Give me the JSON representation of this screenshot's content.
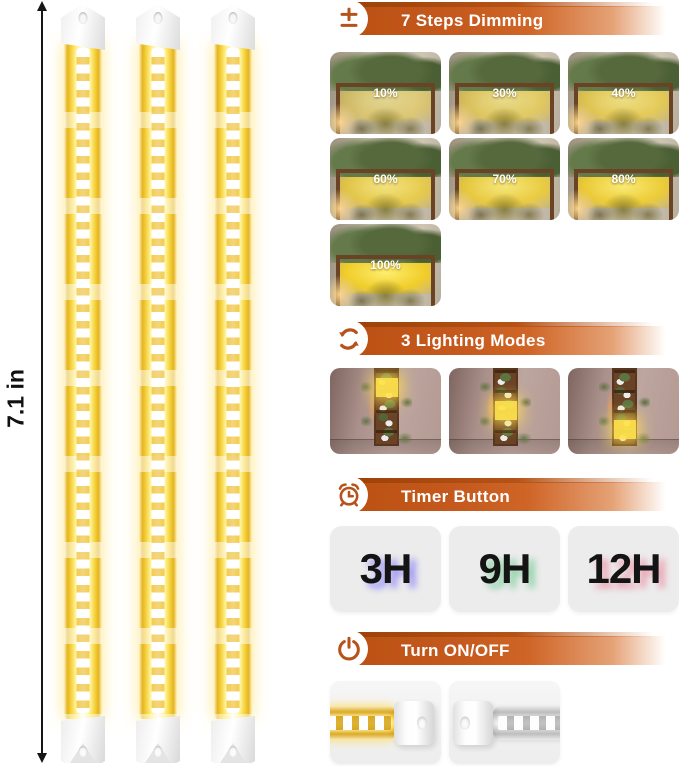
{
  "colors": {
    "banner_orange": "#c65a1e",
    "banner_ridge": "#9e4208",
    "icon_orange": "#b5531a",
    "led_yellow": "#ffe14e",
    "timer_glow_3h": "#9c96f2",
    "timer_glow_9h": "#8fd2a6",
    "timer_glow_12h": "#eaa2b2"
  },
  "left_panel": {
    "dimension_label": "7.1 in",
    "bar_count": 3
  },
  "sections": {
    "dimming": {
      "title": "7 Steps Dimming",
      "icon": "plus-minus-icon",
      "levels": [
        {
          "label": "10%"
        },
        {
          "label": "30%"
        },
        {
          "label": "40%"
        },
        {
          "label": "60%"
        },
        {
          "label": "70%"
        },
        {
          "label": "80%"
        },
        {
          "label": "100%"
        }
      ]
    },
    "modes": {
      "title": "3 Lighting Modes",
      "icon": "cycle-arrows-icon",
      "thumbs": [
        {
          "lit_section": "top"
        },
        {
          "lit_section": "middle"
        },
        {
          "lit_section": "bottom"
        }
      ]
    },
    "timer": {
      "title": "Timer Button",
      "icon": "alarm-clock-icon",
      "options": [
        {
          "label": "3H"
        },
        {
          "label": "9H"
        },
        {
          "label": "12H"
        }
      ]
    },
    "power": {
      "title": "Turn ON/OFF",
      "icon": "power-icon",
      "states": [
        "on",
        "off"
      ]
    }
  }
}
